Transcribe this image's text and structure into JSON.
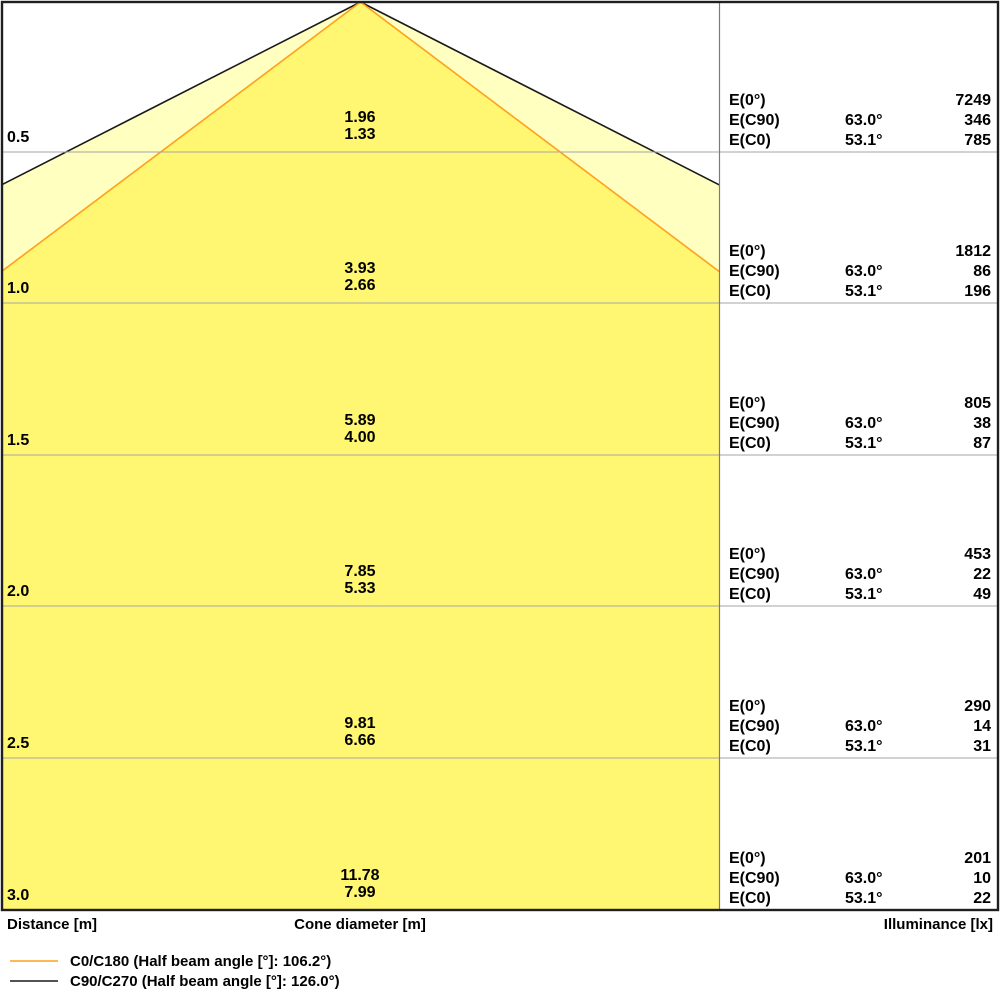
{
  "labels": {
    "e0": "E(0°)",
    "ec90": "E(C90)",
    "ec0": "E(C0)"
  },
  "rows": [
    {
      "distance": "0.5",
      "cone_c90": "1.96",
      "cone_c0": "1.33",
      "e0": "7249",
      "ec90_angle": "63.0°",
      "ec90": "346",
      "ec0_angle": "53.1°",
      "ec0": "785"
    },
    {
      "distance": "1.0",
      "cone_c90": "3.93",
      "cone_c0": "2.66",
      "e0": "1812",
      "ec90_angle": "63.0°",
      "ec90": "86",
      "ec0_angle": "53.1°",
      "ec0": "196"
    },
    {
      "distance": "1.5",
      "cone_c90": "5.89",
      "cone_c0": "4.00",
      "e0": "805",
      "ec90_angle": "63.0°",
      "ec90": "38",
      "ec0_angle": "53.1°",
      "ec0": "87"
    },
    {
      "distance": "2.0",
      "cone_c90": "7.85",
      "cone_c0": "5.33",
      "e0": "453",
      "ec90_angle": "63.0°",
      "ec90": "22",
      "ec0_angle": "53.1°",
      "ec0": "49"
    },
    {
      "distance": "2.5",
      "cone_c90": "9.81",
      "cone_c0": "6.66",
      "e0": "290",
      "ec90_angle": "63.0°",
      "ec90": "14",
      "ec0_angle": "53.1°",
      "ec0": "31"
    },
    {
      "distance": "3.0",
      "cone_c90": "11.78",
      "cone_c0": "7.99",
      "e0": "201",
      "ec90_angle": "63.0°",
      "ec90": "10",
      "ec0_angle": "53.1°",
      "ec0": "22"
    }
  ],
  "footer": {
    "distance": "Distance [m]",
    "cone_diameter": "Cone diameter [m]",
    "illuminance": "Illuminance [lx]"
  },
  "legend": {
    "c0": {
      "label": "C0/C180 (Half beam angle [°]: 106.2°)"
    },
    "c90": {
      "label": "C90/C270 (Half beam angle [°]: 126.0°)"
    }
  },
  "colors": {
    "cone_inner_fill": "#FFF671",
    "cone_outer_fill": "#FFFFC0",
    "c0_line": "#FFA01E",
    "c90_line": "#1A1A1A",
    "grid_line": "#A6A6A6",
    "divider_line": "#7A7A7A",
    "border": "#1F1F1F"
  },
  "chart_data": {
    "type": "table",
    "description_visible_text_only": "Luminous cone diagram with per-distance cone diameters and illuminance values",
    "columns": [
      "Distance [m]",
      "Cone diameter [m]",
      "Illuminance [lx]"
    ],
    "distances_m": [
      0.5,
      1.0,
      1.5,
      2.0,
      2.5,
      3.0
    ],
    "cone_diameter_c90_m": [
      1.96,
      3.93,
      5.89,
      7.85,
      9.81,
      11.78
    ],
    "cone_diameter_c0_m": [
      1.33,
      2.66,
      4.0,
      5.33,
      6.66,
      7.99
    ],
    "E0_lx": [
      7249,
      1812,
      805,
      453,
      290,
      201
    ],
    "EC90_angle_deg": 63.0,
    "EC90_lx": [
      346,
      86,
      38,
      22,
      14,
      10
    ],
    "EC0_angle_deg": 53.1,
    "EC0_lx": [
      785,
      196,
      87,
      49,
      31,
      22
    ],
    "legend": [
      {
        "series": "C0/C180",
        "half_beam_angle_deg": 106.2,
        "color": "#FFA01E"
      },
      {
        "series": "C90/C270",
        "half_beam_angle_deg": 126.0,
        "color": "#1A1A1A"
      }
    ],
    "layout_hints": {
      "legend_position": "bottom-left",
      "grid": "horizontal rows every 0.5 m",
      "cone_apex": "top-center"
    }
  }
}
